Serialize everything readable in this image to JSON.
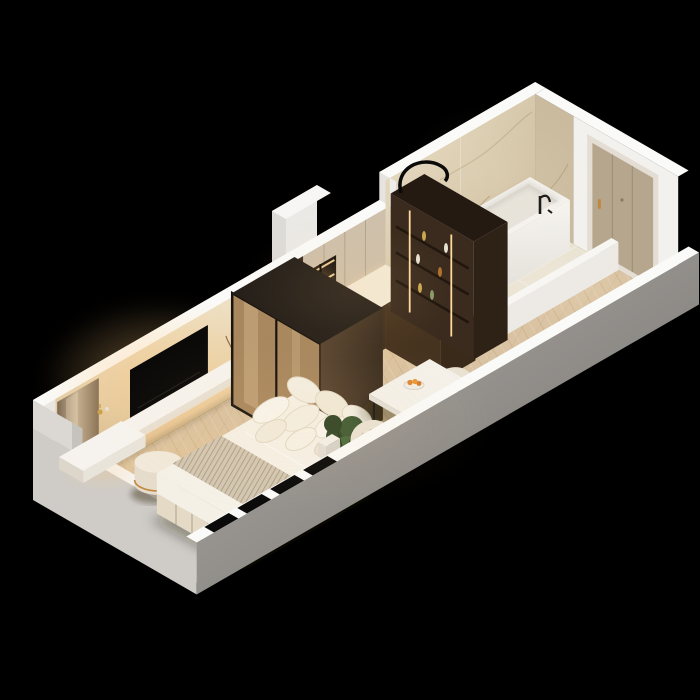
{
  "scene": {
    "type": "3d-isometric-floor-plan",
    "description": "Photorealistic cutaway 3D render of a studio apartment on a black background, long axis running lower-left to upper-right",
    "background": "#000000",
    "rooms": [
      {
        "name": "bedroom",
        "items": [
          "double-bed",
          "striped-throw-blanket",
          "pillow-cluster",
          "floating-vanity-shelf",
          "perfume-bottles",
          "round-pouf",
          "backlit-tv-panel-wall",
          "wall-mounted-tv",
          "floating-tv-shelf",
          "vase-with-dried-flowers",
          "bronze-mirror-panel",
          "window-recesses",
          "potted-plant"
        ]
      },
      {
        "name": "wardrobe-area",
        "items": [
          "bronze-glass-sliding-wardrobe",
          "dark-walnut-wall-panel"
        ]
      },
      {
        "name": "kitchen",
        "items": [
          "backlit-open-shelving-unit",
          "upper-cabinets",
          "cream-countertop",
          "sink",
          "brass-faucet",
          "black-cooktop",
          "walnut-base-cabinets"
        ]
      },
      {
        "name": "dining",
        "items": [
          "white-dining-table",
          "fruit-bowl-with-oranges",
          "cream-barrel-chair-near",
          "cream-barrel-chair-far",
          "white-side-table"
        ]
      },
      {
        "name": "pantry",
        "items": [
          "walnut-display-cabinet",
          "led-light-strips",
          "display-bottles",
          "black-arc-decor"
        ]
      },
      {
        "name": "bathroom",
        "items": [
          "marble-feature-wall",
          "white-bathtub",
          "black-wall-faucet",
          "marble-tile-floor",
          "low-partition-wall",
          "tub-end-partition"
        ]
      },
      {
        "name": "entry",
        "items": [
          "entry-door",
          "gold-door-handle",
          "door-peephole",
          "wood-floor"
        ]
      }
    ]
  },
  "palette": {
    "background": "#000000",
    "wall_white": "#f3f1ed",
    "wall_top": "#fafaf8",
    "wall_outer_light": "#e9e7e3",
    "wall_outer_left": "#cfccc7",
    "wood_floor": "#d9c3a2",
    "marble_floor": "#eae3d3",
    "marble_wall": "#d9cdb6",
    "walnut_dark": "#3a2b1e",
    "walnut_mid": "#4d3826",
    "bronze_glass": "#a8875f",
    "tv_black": "#0b0a09",
    "bed_linen": "#f5f1e7",
    "bed_base": "#e4dac6",
    "blanket": "#cfc2ac",
    "tub_white": "#f4f2ee",
    "door_greige": "#b5a68d",
    "door_frame": "#e3ddd3",
    "gold_accent": "#c08a3e",
    "glow_warm": "#ffc87d",
    "led_warm": "#ffd9a0",
    "plant_green": "#3f5a33",
    "pot_terracotta": "#8d4f2f",
    "orange_fruit": "#e0862f",
    "chair_cream": "#e9e2d3",
    "table_white": "#f4f1ea",
    "cooktop_black": "#141311",
    "counter_cream": "#f3ead7"
  }
}
